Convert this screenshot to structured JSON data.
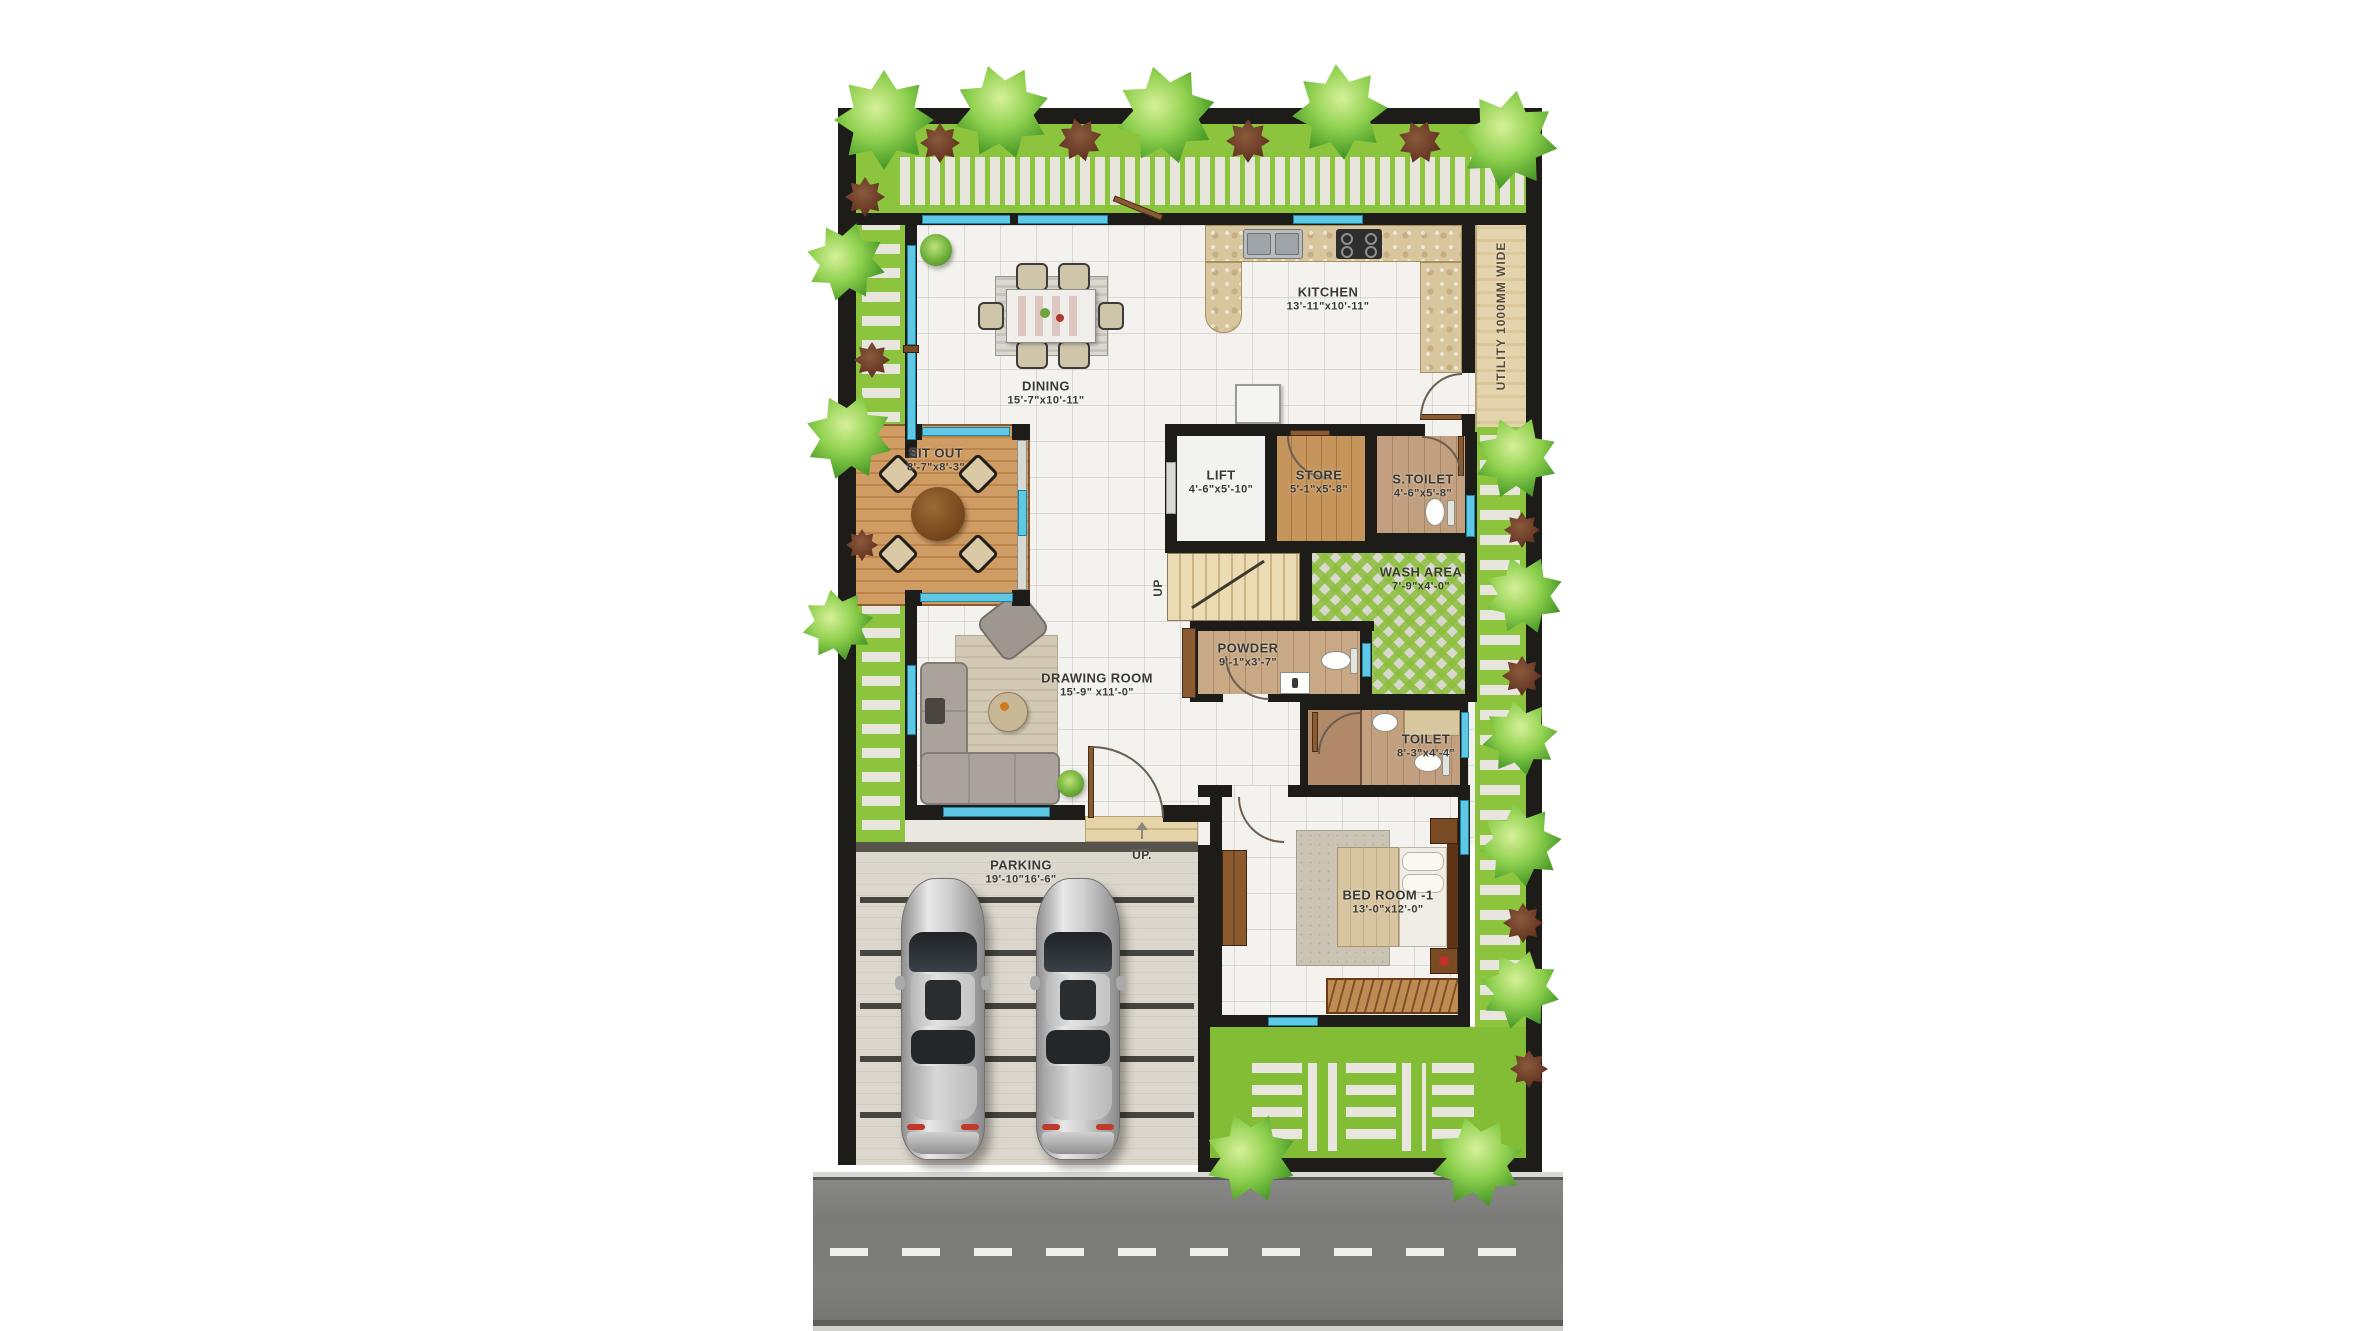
{
  "page": {
    "type": "architectural floor plan (single storey villa, top view render)",
    "background": "#ffffff"
  },
  "rooms": [
    {
      "id": "dining",
      "name": "DINING",
      "dims": "15'-7\"x10'-11\""
    },
    {
      "id": "kitchen",
      "name": "KITCHEN",
      "dims": "13'-11\"x10'-11\""
    },
    {
      "id": "sit-out",
      "name": "SIT OUT",
      "dims": "8'-7\"x8'-3\""
    },
    {
      "id": "lift",
      "name": "LIFT",
      "dims": "4'-6\"x5'-10\""
    },
    {
      "id": "store",
      "name": "STORE",
      "dims": "5'-1\"x5'-8\""
    },
    {
      "id": "s-toilet",
      "name": "S.TOILET",
      "dims": "4'-6\"x5'-8\""
    },
    {
      "id": "wash-area",
      "name": "WASH AREA",
      "dims": "7'-9\"x4'-0\""
    },
    {
      "id": "powder",
      "name": "POWDER",
      "dims": "9'-1\"x3'-7\""
    },
    {
      "id": "toilet",
      "name": "TOILET",
      "dims": "8'-3\"x4'-4\""
    },
    {
      "id": "drawing-room",
      "name": "DRAWING ROOM",
      "dims": "15'-9\" x11'-0\""
    },
    {
      "id": "bedroom-1",
      "name": "BED ROOM -1",
      "dims": "13'-0\"x12'-0\""
    },
    {
      "id": "parking",
      "name": "PARKING",
      "dims": "19'-10\"16'-6\""
    }
  ],
  "annotations": {
    "utility_strip": "UTILITY 1000MM WIDE",
    "stairs_up": "UP",
    "entrance_up": "UP."
  },
  "colors": {
    "wall": "#1d1c18",
    "grass": "#8cc43e",
    "paver": "#e7e5dd",
    "floor_tile": "#f3f2ee",
    "window_glass": "#5fc8e4",
    "deck_wood": "#cf9c64",
    "kitchen_counter": "#d8c69e",
    "bath_floor": "#c2a07f",
    "utility_strip": "#e3d4ad",
    "stairs": "#ecdcb4",
    "parking_floor": "#dcd7cd",
    "road": "#7e7e7e",
    "car_body": "#d6d6d6"
  }
}
